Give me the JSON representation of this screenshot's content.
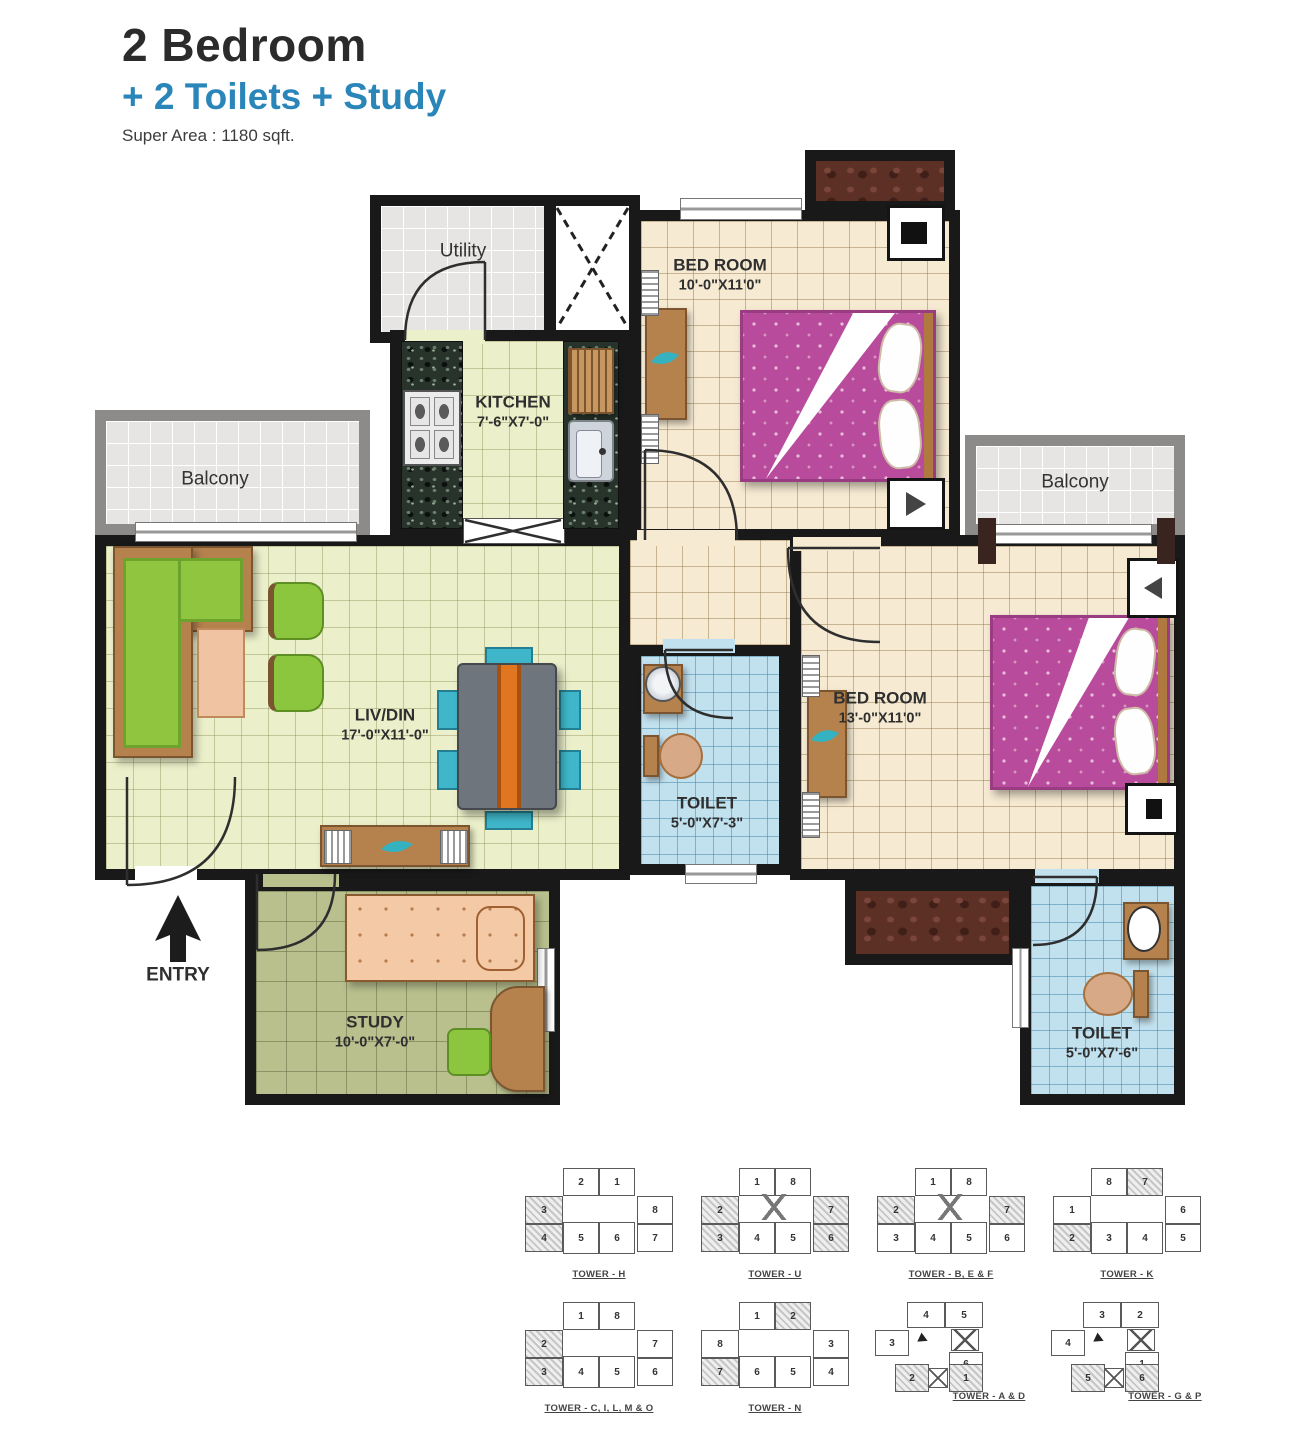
{
  "header": {
    "title": "2 Bedroom",
    "subtitle": "+ 2 Toilets + Study",
    "area": "Super Area : 1180 sqft."
  },
  "colors": {
    "accent_blue": "#2a85b8",
    "wall": "#191919",
    "bed_pink": "#b84b9c",
    "toilet_blue": "#c2e1ee",
    "living_floor": "#ecf0ca",
    "bedroom_floor": "#f6ead2",
    "study_floor": "#b9c08e",
    "balcony_gray": "#e7e5e4"
  },
  "rooms": {
    "utility": {
      "name": "Utility"
    },
    "kitchen": {
      "name": "KITCHEN",
      "dim": "7'-6\"X7'-0\""
    },
    "bedroom1": {
      "name": "BED ROOM",
      "dim": "10'-0\"X11'0\""
    },
    "bedroom2": {
      "name": "BED ROOM",
      "dim": "13'-0\"X11'0\""
    },
    "livdin": {
      "name": "LIV/DIN",
      "dim": "17'-0\"X11'-0\""
    },
    "toilet1": {
      "name": "TOILET",
      "dim": "5'-0\"X7'-3\""
    },
    "toilet2": {
      "name": "TOILET",
      "dim": "5'-0\"X7'-6\""
    },
    "study": {
      "name": "STUDY",
      "dim": "10'-0\"X7'-0\""
    },
    "balcony_left": {
      "name": "Balcony"
    },
    "balcony_right": {
      "name": "Balcony"
    },
    "entry": {
      "label": "ENTRY"
    }
  },
  "towers": [
    {
      "label": "TOWER - H",
      "type": "spread",
      "cross": false,
      "units": {
        "top": [
          "2",
          "1"
        ],
        "left": [
          {
            "n": "3",
            "s": 1
          },
          {
            "n": "4",
            "s": 1
          }
        ],
        "mid": [
          "5",
          "6"
        ],
        "right": [
          "8",
          "7"
        ]
      }
    },
    {
      "label": "TOWER - U",
      "type": "spread",
      "cross": true,
      "units": {
        "top": [
          "1",
          "8"
        ],
        "left": [
          {
            "n": "2",
            "s": 1
          },
          {
            "n": "3",
            "s": 1
          }
        ],
        "mid": [
          "4",
          "5"
        ],
        "right": [
          {
            "n": "7",
            "s": 1
          },
          {
            "n": "6",
            "s": 1
          }
        ]
      }
    },
    {
      "label": "TOWER - B, E & F",
      "type": "spread",
      "cross": true,
      "units": {
        "top": [
          "1",
          "8"
        ],
        "left": [
          {
            "n": "2",
            "s": 1
          },
          "3"
        ],
        "mid": [
          "4",
          "5"
        ],
        "right": [
          {
            "n": "7",
            "s": 1
          },
          "6"
        ]
      }
    },
    {
      "label": "TOWER - K",
      "type": "spread",
      "cross": false,
      "units": {
        "top": [
          "8",
          {
            "n": "7",
            "s": 1
          }
        ],
        "left": [
          "1",
          {
            "n": "2",
            "s": 1
          }
        ],
        "mid": [
          "3",
          "4"
        ],
        "right": [
          "6",
          "5"
        ]
      }
    },
    {
      "label": "TOWER - C, I, L, M & O",
      "type": "spread",
      "cross": false,
      "units": {
        "top": [
          "1",
          "8"
        ],
        "left": [
          {
            "n": "2",
            "s": 1
          },
          {
            "n": "3",
            "s": 1
          }
        ],
        "mid": [
          "4",
          "5"
        ],
        "right": [
          "7",
          "6"
        ]
      }
    },
    {
      "label": "TOWER - N",
      "type": "spread",
      "cross": false,
      "units": {
        "top": [
          "1",
          {
            "n": "2",
            "s": 1
          }
        ],
        "left": [
          "8",
          {
            "n": "7",
            "s": 1
          }
        ],
        "mid": [
          "6",
          "5"
        ],
        "right": [
          "3",
          "4"
        ]
      }
    },
    {
      "label": "TOWER - A & D",
      "type": "lshape",
      "units": {
        "top": [
          "4",
          "5"
        ],
        "left": [
          "3"
        ],
        "right": [
          "6"
        ],
        "bottom": [
          {
            "n": "2",
            "s": 1
          },
          {
            "n": "1",
            "s": 1
          }
        ]
      }
    },
    {
      "label": "TOWER - G & P",
      "type": "lshape",
      "units": {
        "top": [
          "3",
          "2"
        ],
        "left": [
          "4"
        ],
        "right": [
          "1"
        ],
        "bottom": [
          {
            "n": "5",
            "s": 1
          },
          {
            "n": "6",
            "s": 1
          }
        ]
      }
    }
  ]
}
